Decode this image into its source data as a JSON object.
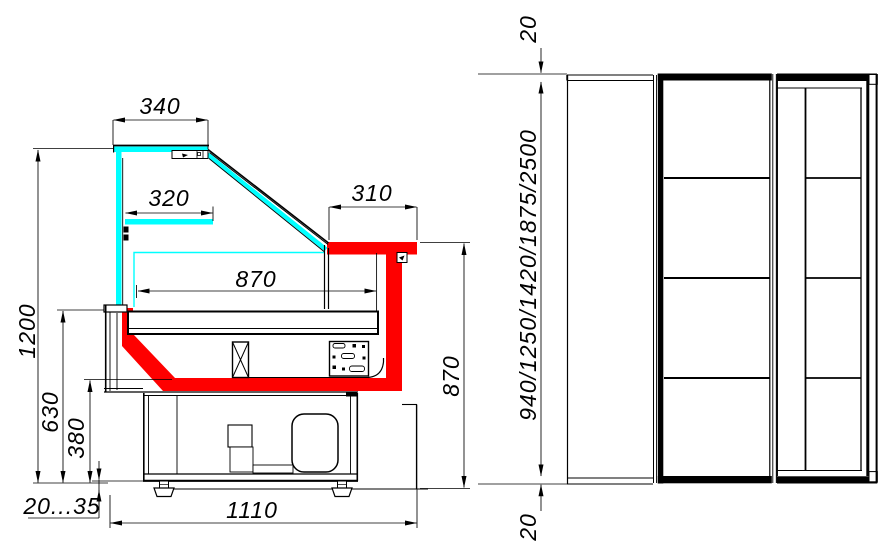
{
  "side_view": {
    "dims": {
      "canopy_top_width": "340",
      "shelf_width": "320",
      "worktop_width": "310",
      "display_deck_width": "870",
      "overall_height": "1200",
      "front_panel_height": "630",
      "tub_bottom_height": "380",
      "leg_adjust_range": "20...35",
      "overall_depth": "1110",
      "worktop_height": "870"
    }
  },
  "plan_view": {
    "dims": {
      "end_panel_top": "20",
      "case_lengths": "940/1250/1420/1875/2500",
      "end_panel_bottom": "20"
    }
  },
  "colors": {
    "glass_highlight": "#00ffff",
    "insulation_highlight": "#fe0000",
    "line": "#000000",
    "background": "#ffffff"
  }
}
